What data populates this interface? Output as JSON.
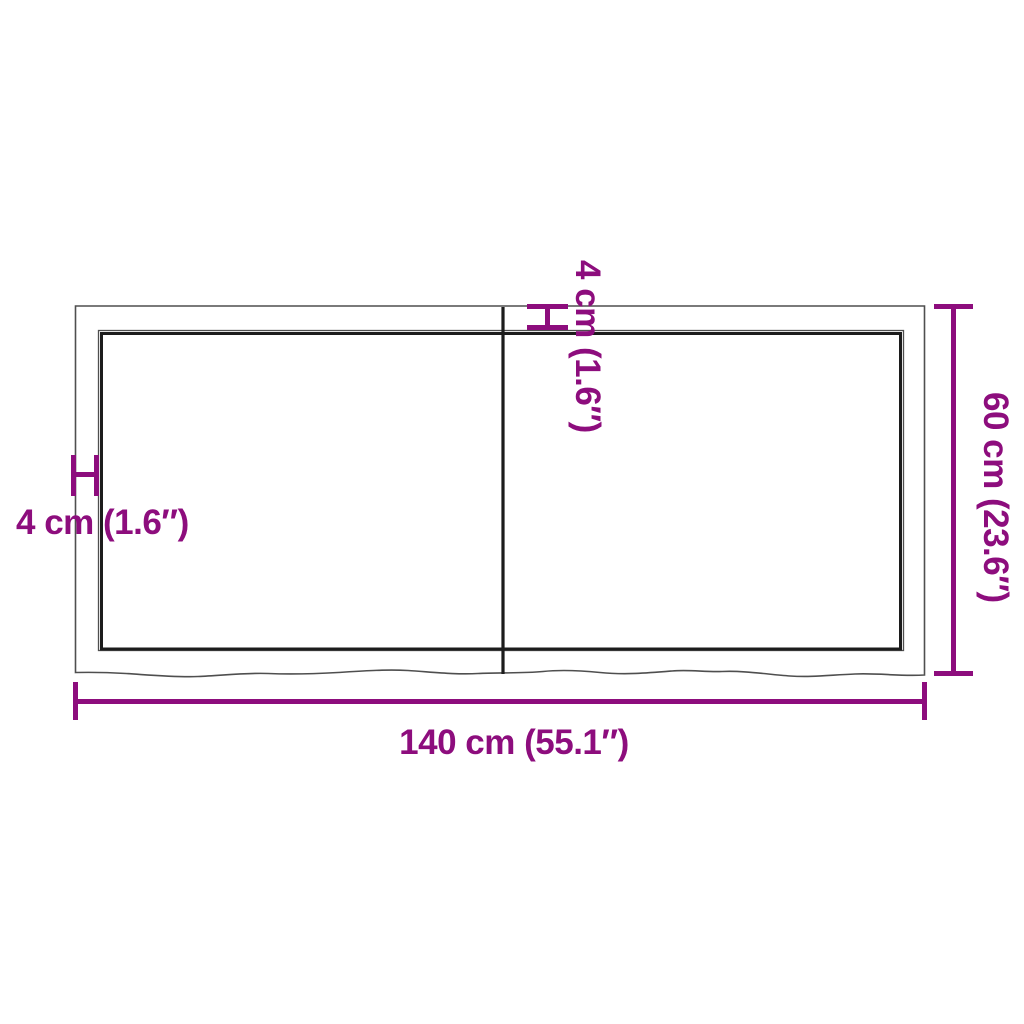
{
  "colors": {
    "background": "#ffffff",
    "accent": "#8D0D7D",
    "panel_edge": "#4f4f4f",
    "panel_inner": "#1c1c1c"
  },
  "labels": {
    "width": "140 cm (55.1″)",
    "height": "60 cm (23.6″)",
    "thickness_left": "4 cm (1.6″)",
    "thickness_top": "4 cm (1.6″)"
  }
}
